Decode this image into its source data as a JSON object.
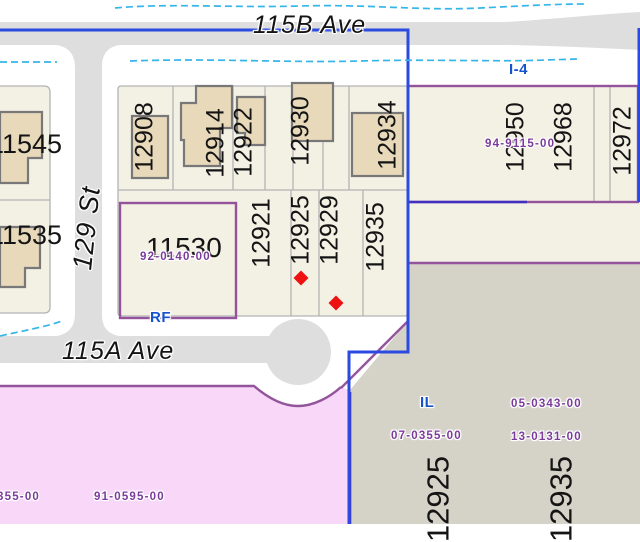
{
  "map": {
    "streets": {
      "ave_115b": "115B Ave",
      "ave_115a": "115A Ave",
      "st_129": "129 St"
    },
    "zones": {
      "i4": "I-4",
      "rf": "RF",
      "il": "IL"
    },
    "parcels": {
      "west": [
        "11545",
        "11535",
        "11530"
      ],
      "block_north": [
        "12908",
        "12914",
        "12922",
        "12930",
        "12934"
      ],
      "block_south": [
        "12921",
        "12925",
        "12929",
        "12935"
      ],
      "east": [
        "12950",
        "12968",
        "12972"
      ],
      "industrial": [
        "12925",
        "12935"
      ]
    },
    "permits": {
      "p92": "92-0140-00",
      "p94": "94-9115-00",
      "p05": "05-0343-00",
      "p07": "07-0355-00",
      "p13": "13-0131-00",
      "p355": "355-00",
      "p91": "91-0595-00"
    },
    "markers": {
      "type": "red-diamond",
      "count": 2
    },
    "colors": {
      "road": "#dedede",
      "parcel_fill": "#f3f0e4",
      "industrial_fill": "#d5d2c8",
      "pink_fill": "#f8d7f8",
      "building_fill": "#e8d9ba",
      "building_line": "#787878",
      "line_gray": "#b4b4b4",
      "boundary_blue": "#2b4ae0",
      "boundary_purple": "#94549c",
      "boundary_indigo": "#4130c0",
      "contour_cyan": "#35b5e8",
      "marker_red": "#ee1111",
      "text_purple": "#7a3b9b",
      "text_blue": "#1453cc",
      "text_black": "#141414"
    }
  }
}
